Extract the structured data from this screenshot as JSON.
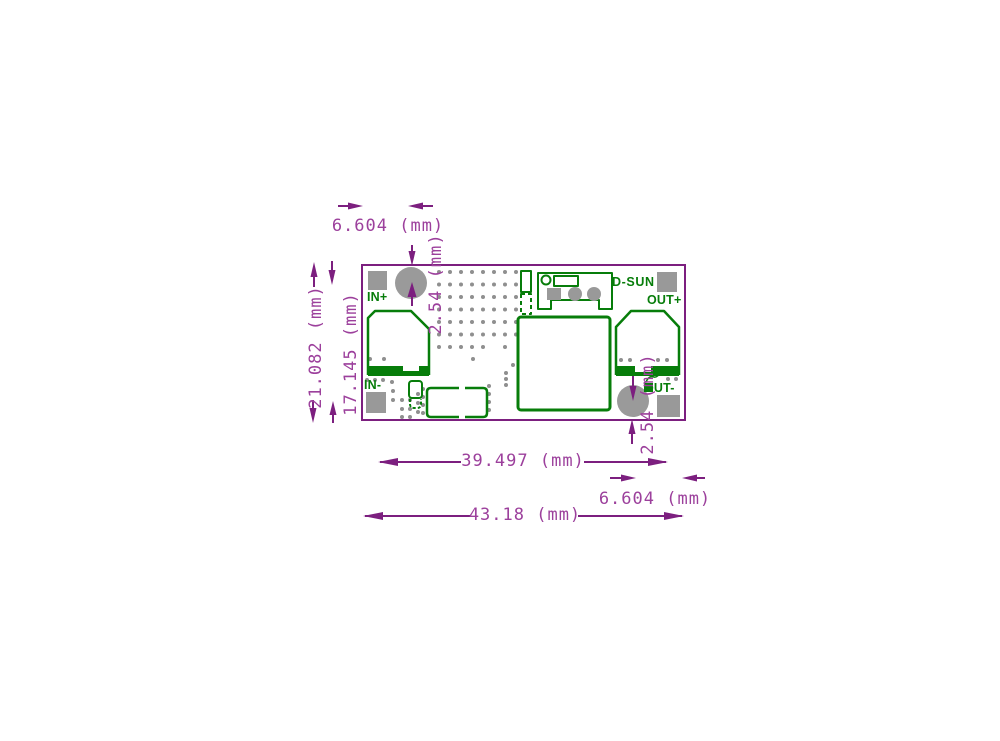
{
  "figure": {
    "kind": "pcb-dimension-drawing",
    "board_labels": {
      "in_plus": "IN+",
      "in_minus": "IN-",
      "out_plus": "OUT+",
      "out_minus": "OUT-",
      "brand": "D-SUN"
    },
    "dimensions": {
      "top_left_offset": "6.604 (mm)",
      "top_hole_offset": "2.54 (mm)",
      "board_height": "21.082 (mm)",
      "pad_row_span": "17.145 (mm)",
      "pad_col_span": "39.497 (mm)",
      "board_width": "43.18 (mm)",
      "bottom_hole_offset": "2.54 (mm)",
      "bottom_right_offset": "6.604 (mm)"
    },
    "colors": {
      "annotation_line": "#7c1f7f",
      "annotation_text": "#9c409c",
      "silkscreen_green": "#077d0a",
      "pad_gray": "#999999",
      "dot_gray": "#8f8f8f",
      "background": "#ffffff"
    }
  }
}
